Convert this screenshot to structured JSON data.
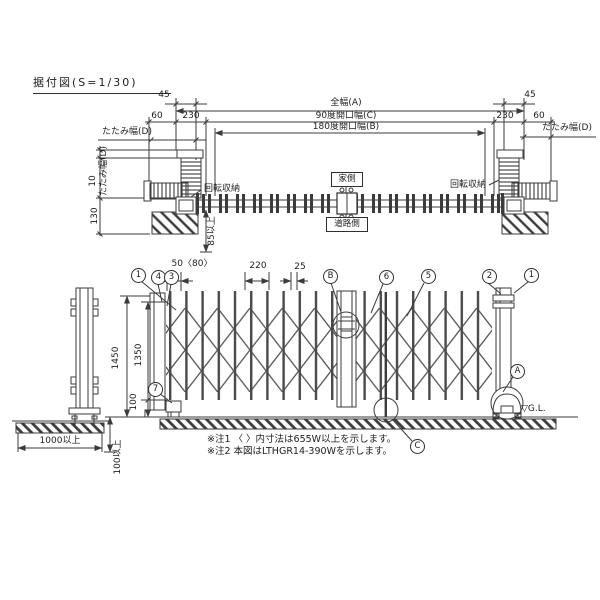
{
  "title": "据付図(S=1/30)",
  "plan_view": {
    "dim_45_left": "45",
    "dim_45_right": "45",
    "dim_total_width": "全幅(A)",
    "dim_open_90": "90度開口幅(C)",
    "dim_open_180": "180度開口幅(B)",
    "dim_60_left": "60",
    "dim_230_left": "230",
    "dim_230_right": "230",
    "dim_60_right": "60",
    "dim_fold_width_left": "たたみ幅(D)",
    "dim_fold_width_left_vertical": "たたみ幅(D)",
    "dim_fold_width_right": "たたみ幅(D)",
    "dim_10": "10",
    "dim_130": "130",
    "dim_85_min": "85以上",
    "label_rotate_storage_left": "回転収納",
    "label_rotate_storage_right": "回転収納",
    "label_house_side": "家側",
    "label_road_side": "道路側"
  },
  "elevation_view": {
    "dim_50_80": "50〈80〉",
    "dim_220": "220",
    "dim_25": "25",
    "dim_1450": "1450",
    "dim_1350": "1350",
    "dim_100": "100",
    "dim_100_min": "100以上",
    "dim_1000_min": "1000以上",
    "label_gl": "▽G.L.",
    "callouts": {
      "c1_left": "1",
      "c4": "4",
      "c3": "3",
      "cB": "B",
      "c6": "6",
      "c5": "5",
      "c2": "2",
      "c1_right": "1",
      "c7": "7",
      "cA": "A",
      "cC": "C"
    }
  },
  "notes": {
    "note1": "※注1 〈 〉内寸法は655W以上を示します。",
    "note2": "※注2 本図はLTHGR14-390Wを示します。"
  },
  "colors": {
    "line": "#3b3b3b",
    "background": "#ffffff"
  }
}
